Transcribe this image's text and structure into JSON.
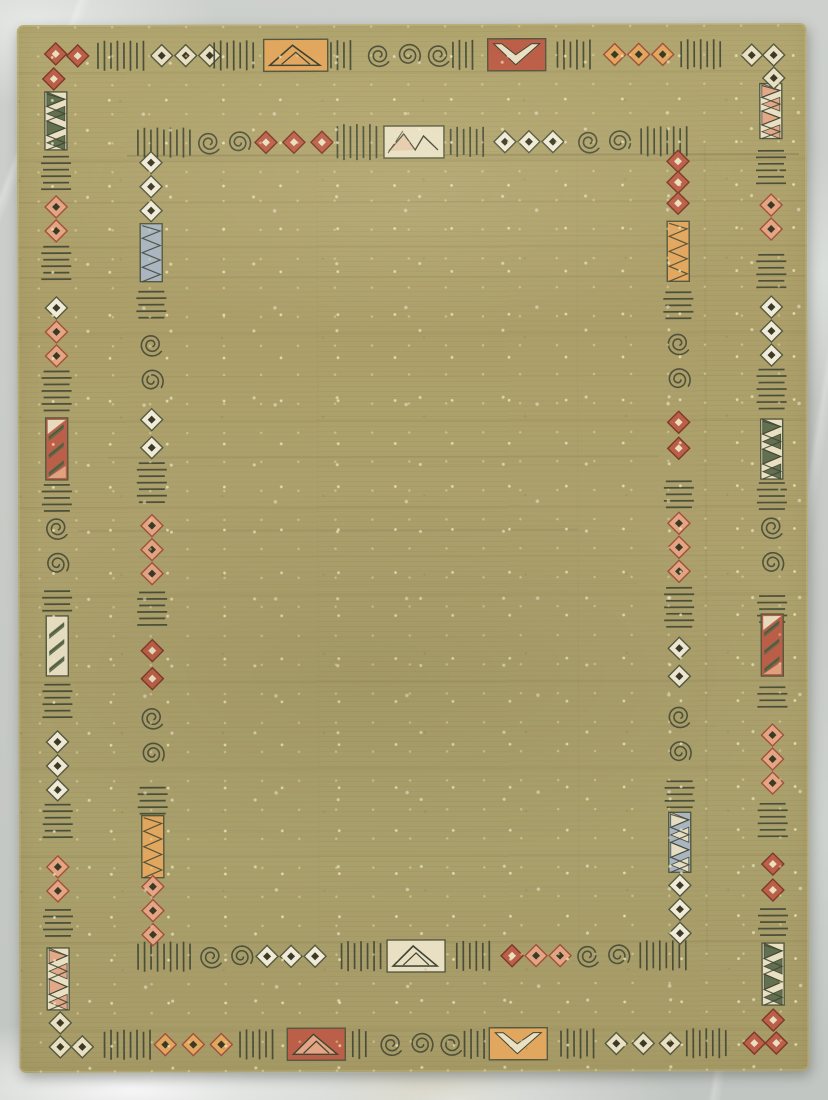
{
  "meta": {
    "description": "Olive green flatweave area rug with Southwest kilim style double border of diamonds, hash marks, scrolls and zigzag cartouches, photographed on a gray marble floor"
  },
  "floor": {
    "color": "#c8cbc7",
    "vein_color": "#ffffff",
    "scuff_color": "#c6b284"
  },
  "rug": {
    "x": 18,
    "y": 24,
    "width": 790,
    "height": 1048,
    "field_color": "#ac9f6b",
    "speckle_color": "#e8dcae",
    "streak_color": "#6e6845"
  },
  "motif_colors": {
    "outline": "#55593f",
    "ink": "#3f4534",
    "dark_center": "#3c3a26",
    "cream": "#e9e0c4",
    "white": "#f0ead8",
    "orange": "#e2a75f",
    "salmon": "#e3a584",
    "red": "#bc5f48",
    "rust": "#a1513c",
    "blue": "#a9b5c1",
    "green": "#5b6a49"
  },
  "borders": {
    "outer_top": {
      "orientation": "h",
      "pos": 31,
      "items": [
        {
          "t": "hash",
          "c": 104,
          "n": 8
        },
        {
          "t": "dia",
          "c": 169,
          "colors": [
            "cream",
            "cream",
            "cream"
          ]
        },
        {
          "t": "hash",
          "c": 217,
          "n": 7
        },
        {
          "t": "hrect",
          "c": 279,
          "w": 64,
          "fill": "orange",
          "motif": "mountain"
        },
        {
          "t": "hash",
          "c": 324,
          "n": 4
        },
        {
          "t": "scroll",
          "c": 392,
          "n": 3
        },
        {
          "t": "hash",
          "c": 446,
          "n": 4
        },
        {
          "t": "hrect",
          "c": 500,
          "w": 58,
          "fill": "red",
          "motif": "vee"
        },
        {
          "t": "hash",
          "c": 557,
          "n": 6
        },
        {
          "t": "dia",
          "c": 622,
          "colors": [
            "orange",
            "orange",
            "orange"
          ]
        },
        {
          "t": "hash",
          "c": 684,
          "n": 7
        }
      ]
    },
    "inner_top": {
      "orientation": "h",
      "pos": 118,
      "items": [
        {
          "t": "hash",
          "c": 147,
          "n": 9
        },
        {
          "t": "scroll",
          "c": 207,
          "n": 2
        },
        {
          "t": "dia",
          "c": 277,
          "colors": [
            "red",
            "red",
            "red"
          ],
          "gap": 28
        },
        {
          "t": "hash",
          "c": 340,
          "n": 7,
          "len": 32
        },
        {
          "t": "hrect",
          "c": 397,
          "w": 60,
          "fill": "cream",
          "motif": "tri"
        },
        {
          "t": "hash",
          "c": 450,
          "n": 6
        },
        {
          "t": "dia",
          "c": 512,
          "colors": [
            "white",
            "white",
            "white"
          ]
        },
        {
          "t": "scroll",
          "c": 587,
          "n": 2
        },
        {
          "t": "hash",
          "c": 647,
          "n": 8
        }
      ]
    },
    "inner_bottom": {
      "orientation": "h",
      "pos": 932,
      "items": [
        {
          "t": "hash",
          "c": 145,
          "n": 9
        },
        {
          "t": "scroll",
          "c": 207,
          "n": 2
        },
        {
          "t": "dia",
          "c": 272,
          "colors": [
            "white",
            "white",
            "white"
          ]
        },
        {
          "t": "hash",
          "c": 342,
          "n": 7
        },
        {
          "t": "hrect",
          "c": 397,
          "w": 58,
          "fill": "cream",
          "motif": "mountain"
        },
        {
          "t": "hash",
          "c": 454,
          "n": 6
        },
        {
          "t": "dia",
          "c": 517,
          "colors": [
            "red",
            "salmon",
            "salmon"
          ]
        },
        {
          "t": "scroll",
          "c": 584,
          "n": 2
        },
        {
          "t": "hash",
          "c": 644,
          "n": 8
        }
      ]
    },
    "outer_bottom": {
      "orientation": "h",
      "pos": 1020,
      "items": [
        {
          "t": "hash",
          "c": 108,
          "n": 8
        },
        {
          "t": "dia",
          "c": 174,
          "colors": [
            "orange",
            "orange",
            "orange"
          ],
          "gap": 28
        },
        {
          "t": "hash",
          "c": 237,
          "n": 6
        },
        {
          "t": "hrect",
          "c": 297,
          "w": 58,
          "fill": "red",
          "motif": "mountain",
          "mfill": "salmon"
        },
        {
          "t": "hash",
          "c": 340,
          "n": 3
        },
        {
          "t": "scroll",
          "c": 402,
          "n": 3
        },
        {
          "t": "hash",
          "c": 455,
          "n": 4
        },
        {
          "t": "hrect",
          "c": 499,
          "w": 58,
          "fill": "orange",
          "motif": "vee"
        },
        {
          "t": "hash",
          "c": 558,
          "n": 6
        },
        {
          "t": "dia",
          "c": 624,
          "colors": [
            "cream",
            "cream",
            "cream"
          ],
          "gap": 27
        },
        {
          "t": "hash",
          "c": 687,
          "n": 7
        }
      ]
    },
    "outer_left": {
      "orientation": "v",
      "pos": 39,
      "items": [
        {
          "t": "vrect",
          "c": 96,
          "h": 58,
          "fill": "cream",
          "motif": "zz",
          "tri": "green"
        },
        {
          "t": "hash",
          "c": 148,
          "n": 6
        },
        {
          "t": "dia",
          "c": 194,
          "colors": [
            "salmon",
            "salmon"
          ]
        },
        {
          "t": "hash",
          "c": 238,
          "n": 6
        },
        {
          "t": "dia",
          "c": 307,
          "colors": [
            "white",
            "salmon",
            "salmon"
          ]
        },
        {
          "t": "hash",
          "c": 366,
          "n": 7
        },
        {
          "t": "vrect",
          "c": 424,
          "h": 62,
          "fill": "red",
          "motif": "diag",
          "tri": "green"
        },
        {
          "t": "hash",
          "c": 473,
          "n": 5
        },
        {
          "t": "scroll",
          "c": 521,
          "n": 2
        },
        {
          "t": "hash",
          "c": 576,
          "n": 4
        },
        {
          "t": "vrect",
          "c": 621,
          "h": 60,
          "fill": "cream",
          "motif": "diag",
          "tri": "green"
        },
        {
          "t": "hash",
          "c": 676,
          "n": 6
        },
        {
          "t": "dia",
          "c": 741,
          "colors": [
            "white",
            "white",
            "white"
          ]
        },
        {
          "t": "hash",
          "c": 796,
          "n": 6
        },
        {
          "t": "dia",
          "c": 854,
          "colors": [
            "salmon",
            "salmon"
          ]
        },
        {
          "t": "hash",
          "c": 898,
          "n": 5
        },
        {
          "t": "vrect",
          "c": 954,
          "h": 62,
          "fill": "cream",
          "motif": "zz",
          "tri": "salmon"
        }
      ]
    },
    "inner_left": {
      "orientation": "v",
      "pos": 134,
      "items": [
        {
          "t": "dia",
          "c": 162,
          "colors": [
            "white",
            "white",
            "white"
          ]
        },
        {
          "t": "vrect",
          "c": 228,
          "h": 58,
          "fill": "blue",
          "motif": "zz",
          "tri": "none"
        },
        {
          "t": "hash",
          "c": 280,
          "n": 5
        },
        {
          "t": "scroll",
          "c": 338,
          "n": 2
        },
        {
          "t": "dia",
          "c": 409,
          "colors": [
            "white",
            "white"
          ],
          "gap": 28
        },
        {
          "t": "hash",
          "c": 458,
          "n": 7
        },
        {
          "t": "dia",
          "c": 525,
          "colors": [
            "salmon",
            "salmon",
            "salmon"
          ]
        },
        {
          "t": "hash",
          "c": 584,
          "n": 6
        },
        {
          "t": "dia",
          "c": 640,
          "colors": [
            "red",
            "red"
          ],
          "gap": 28
        },
        {
          "t": "scroll",
          "c": 711,
          "n": 2
        },
        {
          "t": "hash",
          "c": 776,
          "n": 5
        },
        {
          "t": "vrect",
          "c": 822,
          "h": 62,
          "fill": "orange",
          "motif": "zz",
          "tri": "none"
        },
        {
          "t": "dia",
          "c": 886,
          "colors": [
            "salmon",
            "salmon",
            "salmon"
          ]
        }
      ]
    },
    "inner_right": {
      "orientation": "v",
      "pos": 661,
      "items": [
        {
          "t": "dia",
          "c": 159,
          "colors": [
            "red",
            "red",
            "red"
          ],
          "gap": 21
        },
        {
          "t": "vrect",
          "c": 228,
          "h": 60,
          "fill": "orange",
          "motif": "zz",
          "tri": "none"
        },
        {
          "t": "hash",
          "c": 282,
          "n": 5
        },
        {
          "t": "scroll",
          "c": 338,
          "n": 2
        },
        {
          "t": "dia",
          "c": 412,
          "colors": [
            "red",
            "red"
          ],
          "gap": 26
        },
        {
          "t": "hash",
          "c": 471,
          "n": 5
        },
        {
          "t": "dia",
          "c": 524,
          "colors": [
            "salmon",
            "salmon",
            "salmon"
          ]
        },
        {
          "t": "hash",
          "c": 584,
          "n": 7
        },
        {
          "t": "dia",
          "c": 639,
          "colors": [
            "white",
            "white"
          ],
          "gap": 28
        },
        {
          "t": "scroll",
          "c": 711,
          "n": 2
        },
        {
          "t": "hash",
          "c": 771,
          "n": 5
        },
        {
          "t": "vrect",
          "c": 819,
          "h": 60,
          "fill": "blue",
          "motif": "zz",
          "tri": "cream"
        },
        {
          "t": "dia",
          "c": 886,
          "colors": [
            "white",
            "white",
            "white"
          ]
        }
      ]
    },
    "outer_right": {
      "orientation": "v",
      "pos": 754,
      "items": [
        {
          "t": "vrect",
          "c": 88,
          "h": 55,
          "fill": "cream",
          "motif": "zz",
          "tri": "salmon"
        },
        {
          "t": "hash",
          "c": 144,
          "n": 6
        },
        {
          "t": "dia",
          "c": 194,
          "colors": [
            "salmon",
            "salmon"
          ]
        },
        {
          "t": "hash",
          "c": 248,
          "n": 6
        },
        {
          "t": "dia",
          "c": 308,
          "colors": [
            "white",
            "white",
            "white"
          ]
        },
        {
          "t": "hash",
          "c": 366,
          "n": 7
        },
        {
          "t": "vrect",
          "c": 426,
          "h": 60,
          "fill": "cream",
          "motif": "zz",
          "tri": "green"
        },
        {
          "t": "hash",
          "c": 473,
          "n": 5
        },
        {
          "t": "scroll",
          "c": 522,
          "n": 2
        },
        {
          "t": "hash",
          "c": 586,
          "n": 5
        },
        {
          "t": "vrect",
          "c": 622,
          "h": 62,
          "fill": "red",
          "motif": "diag",
          "tri": "green"
        },
        {
          "t": "hash",
          "c": 674,
          "n": 4
        },
        {
          "t": "dia",
          "c": 736,
          "colors": [
            "salmon",
            "salmon",
            "salmon"
          ]
        },
        {
          "t": "hash",
          "c": 797,
          "n": 6
        },
        {
          "t": "dia",
          "c": 854,
          "colors": [
            "red",
            "red"
          ],
          "gap": 26
        },
        {
          "t": "hash",
          "c": 899,
          "n": 5
        },
        {
          "t": "vrect",
          "c": 951,
          "h": 62,
          "fill": "cream",
          "motif": "zz",
          "tri": "green"
        }
      ]
    }
  },
  "corners": [
    {
      "name": "top-left",
      "color": "red",
      "d": [
        [
          39,
          29
        ],
        [
          61,
          31
        ],
        [
          37,
          54
        ]
      ]
    },
    {
      "name": "top-right",
      "color": "cream",
      "d": [
        [
          735,
          32
        ],
        [
          757,
          32
        ],
        [
          757,
          55
        ]
      ]
    },
    {
      "name": "bottom-left",
      "color": "cream",
      "d": [
        [
          41,
          998
        ],
        [
          41,
          1022
        ],
        [
          63,
          1022
        ]
      ]
    },
    {
      "name": "bottom-right",
      "color": "red",
      "d": [
        [
          754,
          997
        ],
        [
          735,
          1020
        ],
        [
          757,
          1020
        ]
      ]
    }
  ],
  "streaks": [
    {
      "a": "h",
      "p": 131,
      "x1": 110,
      "x2": 782,
      "o": 0.3,
      "w": 2
    },
    {
      "a": "h",
      "p": 137,
      "x1": 20,
      "x2": 770,
      "o": 0.12,
      "w": 1
    },
    {
      "a": "h",
      "p": 178,
      "x1": 2,
      "x2": 788,
      "o": 0.1,
      "w": 2
    },
    {
      "a": "h",
      "p": 212,
      "x1": 30,
      "x2": 760,
      "o": 0.07,
      "w": 1
    },
    {
      "a": "h",
      "p": 253,
      "x1": 2,
      "x2": 788,
      "o": 0.1,
      "w": 2
    },
    {
      "a": "h",
      "p": 352,
      "x1": 40,
      "x2": 720,
      "o": 0.07,
      "w": 1
    },
    {
      "a": "h",
      "p": 433,
      "x1": 90,
      "x2": 640,
      "o": 0.12,
      "w": 2
    },
    {
      "a": "h",
      "p": 441,
      "x1": 150,
      "x2": 700,
      "o": 0.08,
      "w": 1
    },
    {
      "a": "h",
      "p": 506,
      "x1": 60,
      "x2": 560,
      "o": 0.15,
      "w": 2
    },
    {
      "a": "h",
      "p": 532,
      "x1": 120,
      "x2": 780,
      "o": 0.1,
      "w": 1
    },
    {
      "a": "h",
      "p": 560,
      "x1": 200,
      "x2": 620,
      "o": 0.08,
      "w": 1
    },
    {
      "a": "h",
      "p": 614,
      "x1": 40,
      "x2": 750,
      "o": 0.07,
      "w": 1
    },
    {
      "a": "h",
      "p": 703,
      "x1": 80,
      "x2": 700,
      "o": 0.06,
      "w": 1
    },
    {
      "a": "h",
      "p": 806,
      "x1": 60,
      "x2": 740,
      "o": 0.08,
      "w": 1
    },
    {
      "a": "h",
      "p": 864,
      "x1": 120,
      "x2": 700,
      "o": 0.09,
      "w": 1
    },
    {
      "a": "h",
      "p": 918,
      "x1": 40,
      "x2": 760,
      "o": 0.08,
      "w": 1
    },
    {
      "a": "v",
      "p": 560,
      "x1": 130,
      "x2": 930,
      "o": 0.05,
      "w": 1
    },
    {
      "a": "v",
      "p": 688,
      "x1": 120,
      "x2": 935,
      "o": 0.08,
      "w": 2
    },
    {
      "a": "v",
      "p": 300,
      "x1": 130,
      "x2": 930,
      "o": 0.04,
      "w": 1
    }
  ]
}
